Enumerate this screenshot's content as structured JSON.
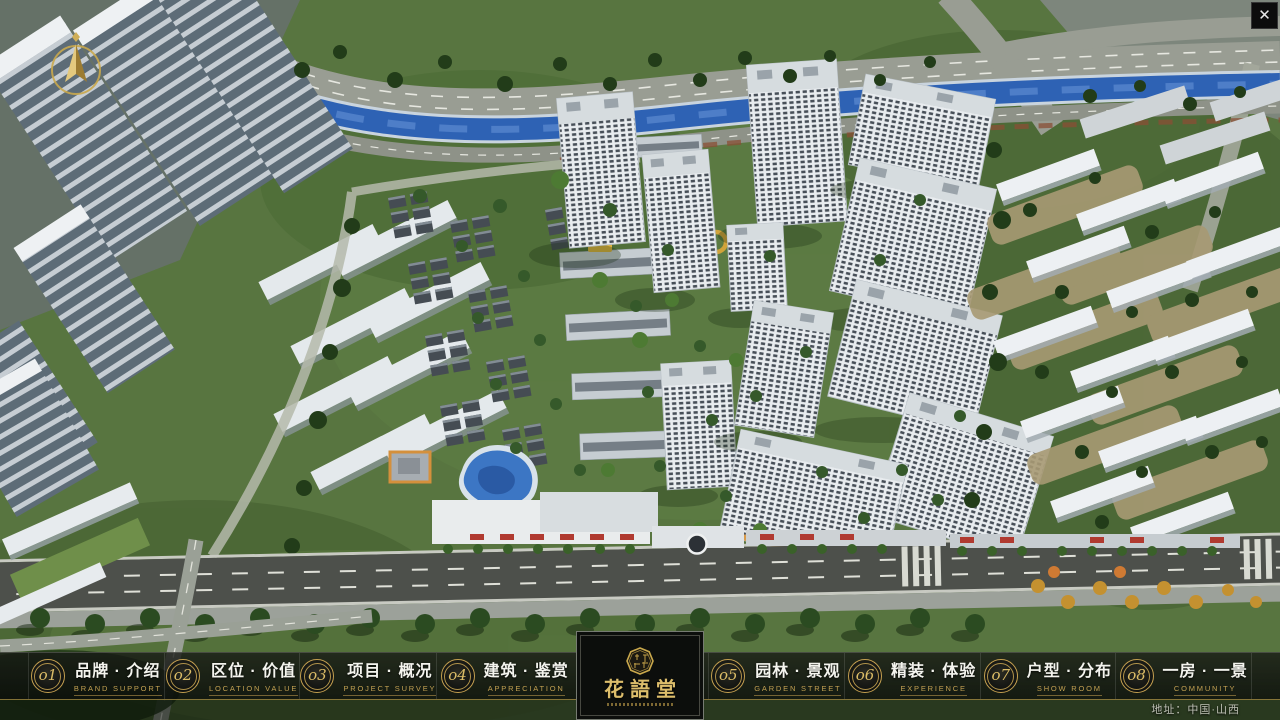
{
  "window": {
    "close_label": "✕"
  },
  "nav": {
    "items": [
      {
        "num": "o1",
        "zh": "品牌 · 介绍",
        "en": "BRAND SUPPORT"
      },
      {
        "num": "o2",
        "zh": "区位 · 价值",
        "en": "LOCATION VALUE"
      },
      {
        "num": "o3",
        "zh": "项目 · 概况",
        "en": "PROJECT SURVEY"
      },
      {
        "num": "o4",
        "zh": "建筑 · 鉴赏",
        "en": "APPRECIATION"
      },
      {
        "num": "o5",
        "zh": "园林 · 景观",
        "en": "GARDEN STREET"
      },
      {
        "num": "o6",
        "zh": "精装 · 体验",
        "en": "EXPERIENCE"
      },
      {
        "num": "o7",
        "zh": "户型 · 分布",
        "en": "SHOW ROOM"
      },
      {
        "num": "o8",
        "zh": "一房 · 一景",
        "en": "COMMUNITY"
      }
    ]
  },
  "logo": {
    "name": "花語堂"
  },
  "footer": {
    "address": "地址：中国·山西"
  },
  "colors": {
    "gold": "#c9a84c",
    "nav_bg": "rgba(10,12,10,0.82)",
    "river": "#2e62b4"
  }
}
